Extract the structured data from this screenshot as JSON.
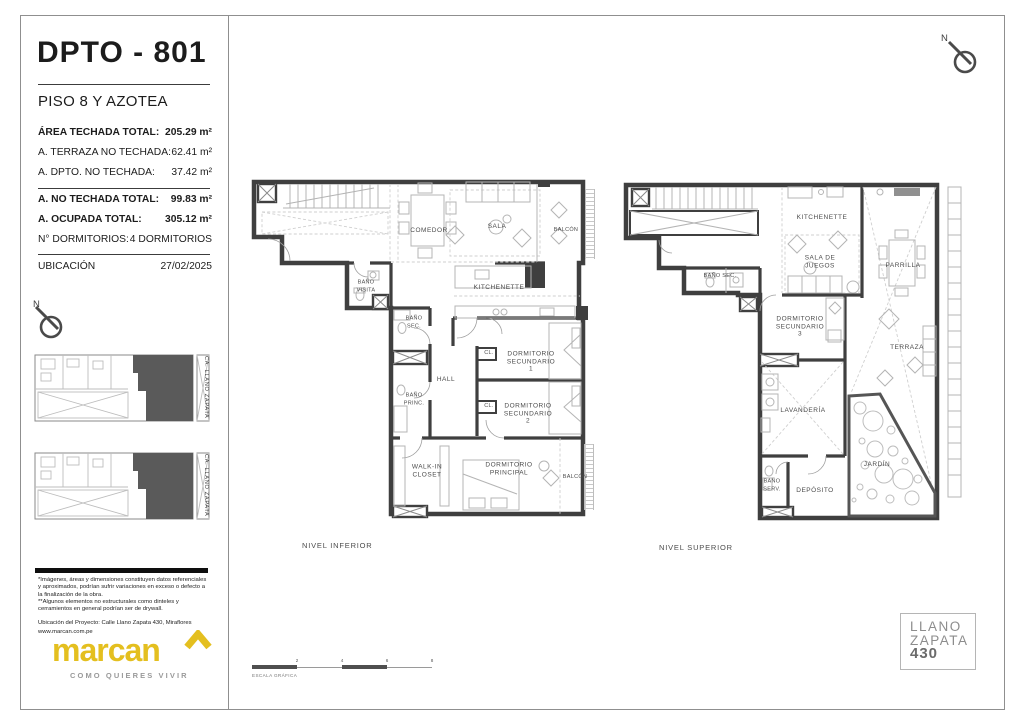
{
  "colors": {
    "brand_yellow": "#e4bf1f",
    "wall_gray": "#3f3f3f",
    "unit_highlight": "#5a5a5a"
  },
  "header": {
    "title": "DPTO - 801",
    "subtitle": "PISO 8 Y AZOTEA",
    "stats": [
      {
        "label": "ÁREA TECHADA TOTAL:",
        "value": "205.29 m²"
      },
      {
        "label": "A. TERRAZA NO TECHADA:",
        "value": "62.41 m²"
      },
      {
        "label": "A. DPTO. NO TECHADA:",
        "value": "37.42 m²"
      },
      {
        "label": "A. NO TECHADA TOTAL:",
        "value": "99.83 m²"
      },
      {
        "label": "A. OCUPADA TOTAL:",
        "value": "305.12 m²"
      },
      {
        "label": "N° DORMITORIOS:",
        "value": "4 DORMITORIOS"
      }
    ],
    "ubicacion_label": "UBICACIÓN",
    "date": "27/02/2025"
  },
  "north": {
    "label": "N"
  },
  "site_maps": {
    "street_label": "CA. LLANO ZAPATA"
  },
  "footer": {
    "disclaimer_1": "*Imágenes, áreas y dimensiones constituyen datos referenciales y aproximados, podrían sufrir variaciones en exceso o defecto a la finalización de la obra.",
    "disclaimer_2": "**Algunos elementos no estructurales como dinteles y cerramientos en general podrían ser de drywall.",
    "project_location": "Ubicación del Proyecto: Calle Llano Zapata 430, Miraflores",
    "website": "www.marcan.com.pe",
    "logo_text": "marcan",
    "logo_tagline": "COMO QUIERES VIVIR"
  },
  "plans": {
    "inferior": {
      "caption": "NIVEL INFERIOR",
      "rooms": {
        "comedor": "COMEDOR",
        "sala": "SALA",
        "balcon_1": "BALCÓN",
        "bano_visita": "BAÑO\nVISITA",
        "kitchenette": "KITCHENETTE",
        "bano_sec": "BAÑO\nSEC.",
        "hall": "HALL",
        "cl": "CL.",
        "dorm_sec_1": "DORMITORIO\nSECUNDARIO\n1",
        "dorm_sec_2": "DORMITORIO\nSECUNDARIO\n2",
        "bano_princ": "BAÑO\nPRINC.",
        "walkin_closet": "WALK-IN\nCLOSET",
        "dorm_principal": "DORMITORIO\nPRINCIPAL",
        "balcon_2": "BALCÓN"
      }
    },
    "superior": {
      "caption": "NIVEL SUPERIOR",
      "rooms": {
        "kitchenette": "KITCHENETTE",
        "sala_de_juegos": "SALA DE\nJUEGOS",
        "parrilla": "PARRILLA",
        "bano_sec": "BAÑO SEC.",
        "dorm_sec_3": "DORMITORIO\nSECUNDARIO\n3",
        "terraza": "TERRAZA",
        "lavanderia": "LAVANDERÍA",
        "bano_serv": "BAÑO\nSERV.",
        "deposito": "DEPÓSITO",
        "jardin": "JARDÍN"
      }
    }
  },
  "scale_bar": {
    "label": "ESCALA GRÁFICA",
    "ticks": [
      "2",
      "4",
      "6",
      "8"
    ]
  },
  "badge": {
    "line_1": "LLANO",
    "line_2": "ZAPATA",
    "line_3": "430"
  }
}
